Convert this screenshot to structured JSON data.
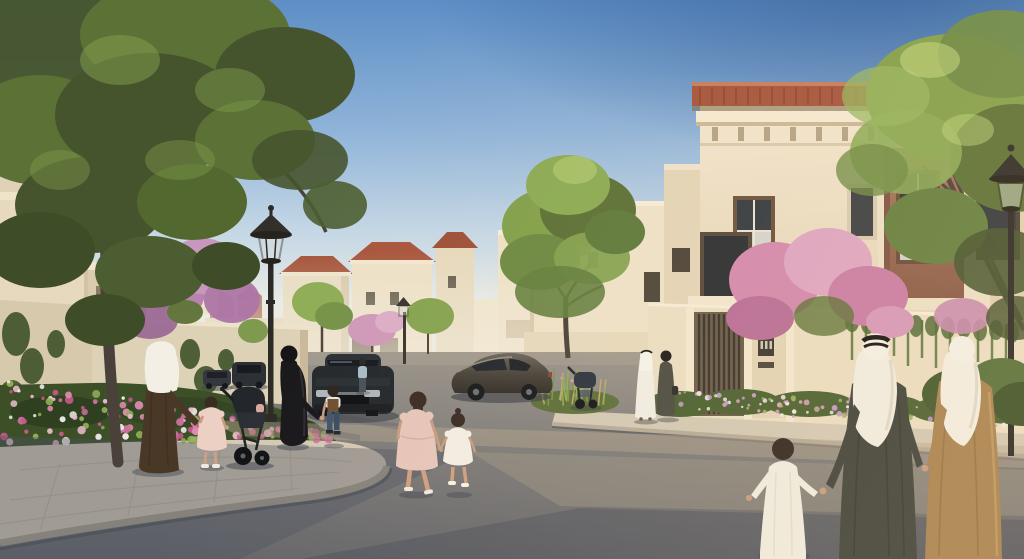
{
  "meta": {
    "title": "Residential community street scene - architectural rendering",
    "description": "Photorealistic render of a Middle Eastern residential neighborhood at golden hour: cream villas with terracotta roofs, a curved street, families in traditional dress walking, parked cars, street lamps, trees and flower beds.",
    "visible_text": "none (a small house-number plaque on the right wall is illegible)"
  },
  "palette": {
    "sky_top": "#5d8ec6",
    "sky_deep": "#2f62a4",
    "sky_horizon": "#efe9da",
    "wall_cream": "#e9dcc2",
    "wall_lit": "#f3e8d1",
    "wall_shade": "#d4c5a9",
    "roof_terracotta": "#a5553c",
    "accent_brown": "#9a6c54",
    "foliage_dark": "#46542e",
    "foliage": "#5c7136",
    "foliage_light": "#83a04b",
    "bougainvillea": "#c588b0",
    "road": "#8d8984",
    "road_shadow": "#5e6166",
    "sidewalk": "#d3c9b5",
    "trunk": "#4a423a",
    "lamp_metal": "#2c2a26",
    "thobe_white": "#f1eee3",
    "abaya_black": "#18171b",
    "robe_brown": "#4a3827",
    "thobe_camel": "#a8824f",
    "thobe_dark": "#3e423a",
    "car_dark": "#24282c",
    "skin": "#c79b7e",
    "dress_blush": "#ecd0c4"
  },
  "vegetation": {
    "flowerbed_colors": [
      "#c45a8a",
      "#e08bb0",
      "#f0e9ea",
      "#c9719b",
      "#e7b9cd",
      "#8fae57"
    ],
    "hedge_colors": [
      "#c39bc8",
      "#dba4bd",
      "#efe6e8",
      "#9ab05e"
    ],
    "grass_colors": [
      "#c2a86a",
      "#8fae57",
      "#7f9448"
    ]
  },
  "scene_inventory": {
    "buildings": [
      "cream two-storey villas with terracotta hip roofs receding down the street",
      "corner villa with decorative tower, clay-tile cap, dentil cornice and mauve-brown window surround",
      "boundary walls with slatted timber gates and vine-covered sections"
    ],
    "signage": [
      {
        "label": "house-number-plaque",
        "text_visible": false
      }
    ],
    "street_furniture": [
      "classic lantern street lamp (left)",
      "small street lamp (middle distance)",
      "lantern street lamp (right)"
    ],
    "vehicles": [
      "dark sedan parked side-on (center)",
      "dark car facing viewer (center-left)",
      "two distant parked cars (left)"
    ],
    "people": [
      "man in brown robe and white ghutra holding a girl's hand (left)",
      "girl in blush dress (left)",
      "toddler in a dark stroller (left)",
      "woman in black abaya holding a small boy's hand",
      "boy in brown vest and jeans",
      "two girls holding hands crossing the street (center)",
      "man in white thobe walking with woman in dark dress (center-right)",
      "empty stroller by the wall (center-right)",
      "boy in white thobe, man in dark thobe with white ghutra, person in camel robe with white ghutra holding hands (right, backs to viewer)",
      "distant pedestrian in light blue shirt"
    ],
    "vegetation_items": [
      "large foreground tree (left)",
      "round green tree (center)",
      "green tree (right, in front of villa)",
      "pink bougainvillea shrubs",
      "foreground flower bed",
      "flower hedge along right wall",
      "ornamental grasses"
    ]
  }
}
